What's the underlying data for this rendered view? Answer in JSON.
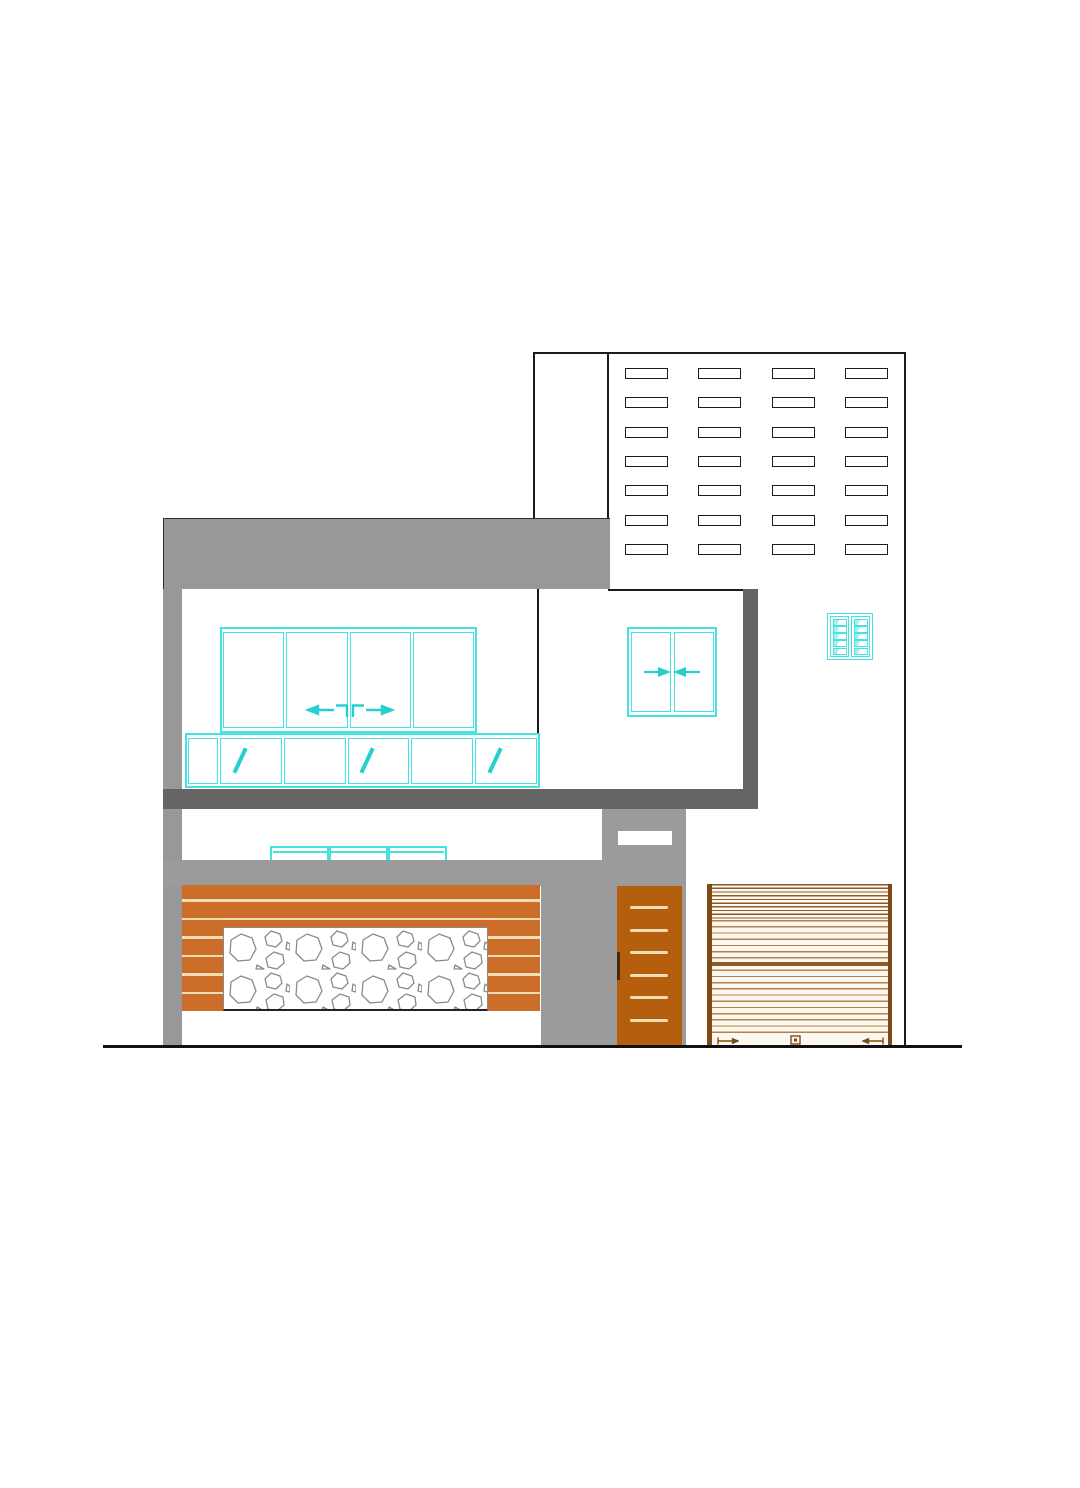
{
  "elevation": {
    "colors": {
      "outline": "#1b1b1b",
      "parapet_gray": "#989898",
      "wall_gray": "#9b9b9b",
      "frame_dark_gray": "#656565",
      "window_cyan": "#45e2e2",
      "glyph_cyan": "#25cfcf",
      "slat_orange": "#cc6e2a",
      "cream": "#f3ddb4",
      "door_orange": "#b55f0e",
      "door_handle_brown": "#4a2806",
      "shutter_bg": "#fdf8ef",
      "shutter_line_light": "#b5824a",
      "shutter_line_dark": "#8a5a28",
      "shutter_guide_brown": "#7d4a15",
      "stone_outline": "#8a8a8a",
      "ground_line": "#111111"
    },
    "vent_grid": {
      "rows": 7,
      "columns": 4
    },
    "upper_sliding_window": {
      "panels": 4,
      "slide_arrows": 2
    },
    "transom_row": {
      "cells": 6,
      "slash_cells": [
        2,
        4,
        6
      ]
    },
    "double_window": {
      "panels": 2,
      "slide_arrows": 2
    },
    "louver_ventilator": {
      "panels": 2,
      "louvers_per_panel": 5
    },
    "ground_floor_window": {
      "cells": 3
    },
    "entry_door": {
      "stripes": 6
    },
    "slat_cladding": {
      "gap_lines": 6
    },
    "rolling_shutter": {
      "bottom_markers": [
        "slide-arrow-left",
        "lock",
        "slide-arrow-right"
      ]
    }
  }
}
